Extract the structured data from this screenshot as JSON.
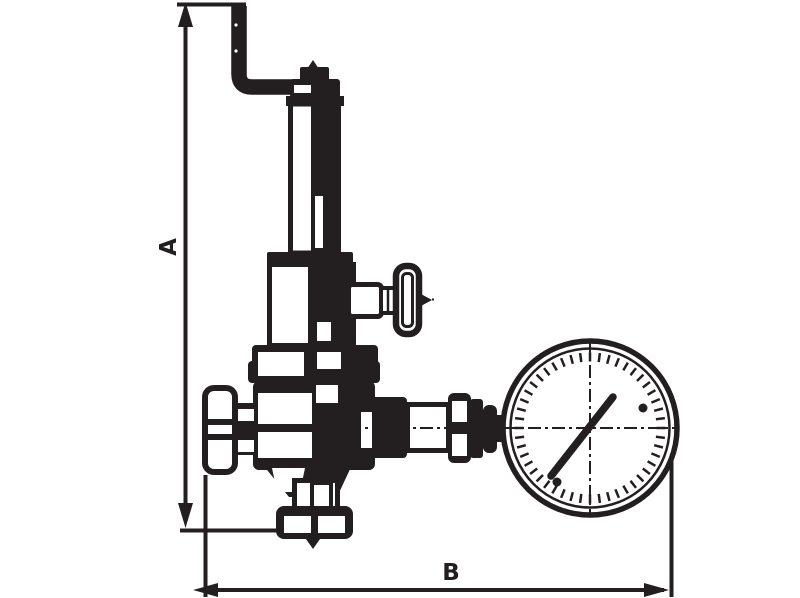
{
  "drawing": {
    "title": "valve-technical-drawing",
    "dimensions": {
      "height_label": "A",
      "width_label": "B"
    },
    "colors": {
      "line": "#231f20",
      "background": "#ffffff"
    },
    "icons": {
      "arrow_up": "dimension-arrowhead-up",
      "arrow_down": "dimension-arrowhead-down",
      "arrow_left": "dimension-arrowhead-left",
      "arrow_right": "dimension-arrowhead-right",
      "gauge_needle": "gauge-needle"
    }
  }
}
